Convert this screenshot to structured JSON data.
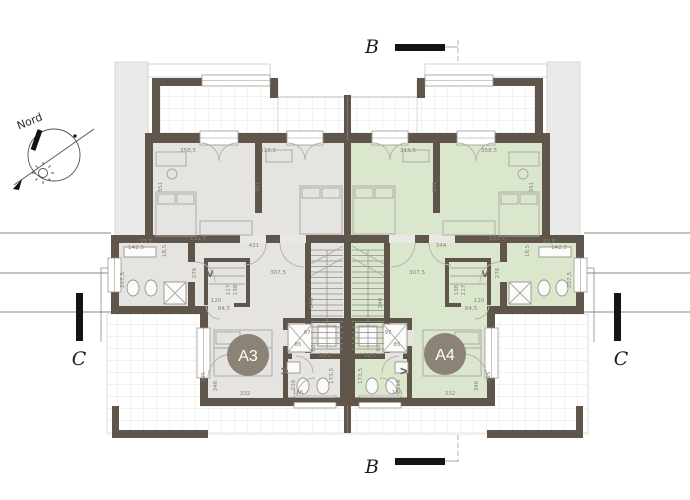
{
  "colors": {
    "wall": "#5f554b",
    "floorA3": "#e5e4e1",
    "floorA4": "#dbe7cc",
    "badge": "#8b8376",
    "roof": "#eaeae9"
  },
  "north": {
    "label": "Nord"
  },
  "section_markers": {
    "b": "B",
    "c": "C"
  },
  "unit_badges": {
    "a3": "A3",
    "a4": "A4"
  },
  "floor_plan": {
    "dimension_labels": [
      {
        "t": "358,5",
        "x": 188,
        "y": 152
      },
      {
        "t": "313,5",
        "x": 268,
        "y": 152
      },
      {
        "t": "351",
        "x": 162,
        "y": 187,
        "r": -90
      },
      {
        "t": "351",
        "x": 259,
        "y": 187,
        "r": -90
      },
      {
        "t": "131,5",
        "x": 198,
        "y": 240
      },
      {
        "t": "31,5",
        "x": 146,
        "y": 243
      },
      {
        "t": "18,5",
        "x": 166,
        "y": 251,
        "r": -90
      },
      {
        "t": "421",
        "x": 254,
        "y": 247
      },
      {
        "t": "142,5",
        "x": 136,
        "y": 249
      },
      {
        "t": "207,5",
        "x": 124,
        "y": 280,
        "r": -90
      },
      {
        "t": "276",
        "x": 196,
        "y": 273,
        "r": -90
      },
      {
        "t": "307,5",
        "x": 278,
        "y": 274
      },
      {
        "t": "V",
        "x": 210,
        "y": 277,
        "s": 9
      },
      {
        "t": "117",
        "x": 230,
        "y": 290,
        "r": -90
      },
      {
        "t": "138",
        "x": 237,
        "y": 290,
        "r": -90
      },
      {
        "t": "120",
        "x": 216,
        "y": 302
      },
      {
        "t": "84,5",
        "x": 224,
        "y": 310
      },
      {
        "t": "246",
        "x": 313,
        "y": 303,
        "r": -90
      },
      {
        "t": "97",
        "x": 307,
        "y": 334
      },
      {
        "t": "85",
        "x": 298,
        "y": 346
      },
      {
        "t": "60",
        "x": 315,
        "y": 348,
        "r": -90
      },
      {
        "t": "59,5",
        "x": 325,
        "y": 357
      },
      {
        "t": "173,5",
        "x": 333,
        "y": 376,
        "r": -90
      },
      {
        "t": "216",
        "x": 295,
        "y": 385,
        "r": -90
      },
      {
        "t": "186",
        "x": 298,
        "y": 394
      },
      {
        "t": "V",
        "x": 288,
        "y": 371,
        "r": -90,
        "s": 9
      },
      {
        "t": "346",
        "x": 217,
        "y": 386,
        "r": -90
      },
      {
        "t": "332",
        "x": 245,
        "y": 395
      },
      {
        "t": "295",
        "x": 205,
        "y": 377,
        "r": -90
      },
      {
        "t": "358,5",
        "x": 489,
        "y": 152
      },
      {
        "t": "313,5",
        "x": 408,
        "y": 152
      },
      {
        "t": "351",
        "x": 533,
        "y": 187,
        "r": -90
      },
      {
        "t": "351",
        "x": 436,
        "y": 187,
        "r": -90
      },
      {
        "t": "131,5",
        "x": 497,
        "y": 240
      },
      {
        "t": "31,5",
        "x": 549,
        "y": 243
      },
      {
        "t": "18,5",
        "x": 529,
        "y": 251,
        "r": -90
      },
      {
        "t": "344",
        "x": 441,
        "y": 247
      },
      {
        "t": "142,5",
        "x": 559,
        "y": 249
      },
      {
        "t": "207,5",
        "x": 571,
        "y": 280,
        "r": -90
      },
      {
        "t": "276",
        "x": 499,
        "y": 273,
        "r": -90
      },
      {
        "t": "307,5",
        "x": 417,
        "y": 274
      },
      {
        "t": "V",
        "x": 485,
        "y": 277,
        "s": 9
      },
      {
        "t": "117",
        "x": 465,
        "y": 290,
        "r": -90
      },
      {
        "t": "138",
        "x": 458,
        "y": 290,
        "r": -90
      },
      {
        "t": "120",
        "x": 479,
        "y": 302
      },
      {
        "t": "84,5",
        "x": 471,
        "y": 310
      },
      {
        "t": "246",
        "x": 382,
        "y": 303,
        "r": -90
      },
      {
        "t": "97",
        "x": 388,
        "y": 334
      },
      {
        "t": "85",
        "x": 397,
        "y": 346
      },
      {
        "t": "60",
        "x": 380,
        "y": 348,
        "r": -90
      },
      {
        "t": "59,5",
        "x": 370,
        "y": 357
      },
      {
        "t": "173,5",
        "x": 362,
        "y": 376,
        "r": -90
      },
      {
        "t": "216",
        "x": 400,
        "y": 385,
        "r": -90
      },
      {
        "t": "186",
        "x": 397,
        "y": 394
      },
      {
        "t": "V",
        "x": 407,
        "y": 371,
        "r": -90,
        "s": 9
      },
      {
        "t": "346",
        "x": 478,
        "y": 386,
        "r": -90
      },
      {
        "t": "332",
        "x": 450,
        "y": 395
      },
      {
        "t": "295",
        "x": 490,
        "y": 377,
        "r": -90
      }
    ]
  }
}
